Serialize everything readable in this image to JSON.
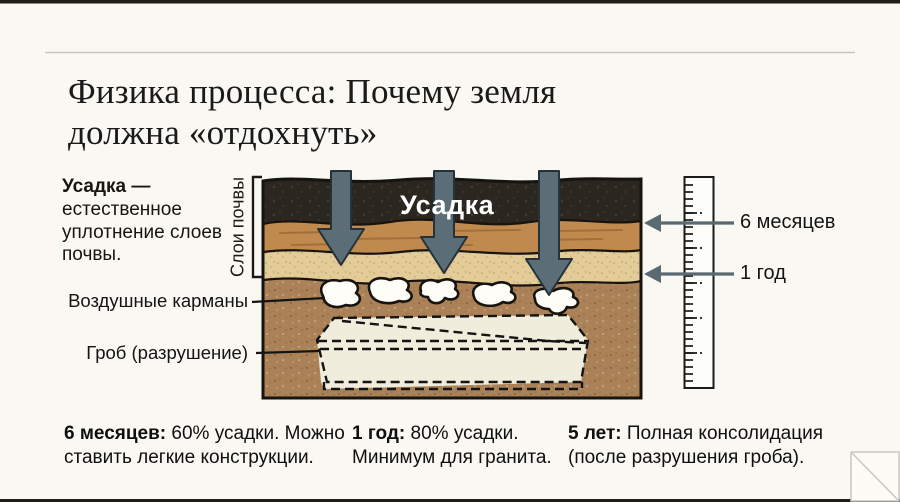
{
  "slide": {
    "title_line1": "Физика процесса: Почему земля",
    "title_line2": "должна «отдохнуть»"
  },
  "definition": {
    "term": "Усадка —",
    "text": "естественное уплотнение слоев почвы."
  },
  "diagram": {
    "side_label": "Слои почвы",
    "center_label": "Усадка",
    "pockets_label": "Воздушные карманы",
    "coffin_label": "Гроб (разрушение)",
    "ruler_marks": [
      {
        "label": "6 месяцев"
      },
      {
        "label": "1 год"
      }
    ]
  },
  "timeline": [
    {
      "term": "6 месяцев:",
      "text": " 60% усадки. Можно ставить легкие конструкции."
    },
    {
      "term": "1 год:",
      "text": " 80% усадки. Минимум для гранита."
    },
    {
      "term": "5 лет:",
      "text": " Полная консолидация (после разрушения гроба)."
    }
  ],
  "colors": {
    "bg": "#faf8f2",
    "bar": "#201d18",
    "rule": "#c9c6bd",
    "soil-dark": "#2c2620",
    "soil-orange": "#c08a4f",
    "soil-tan": "#e3cc98",
    "soil-brown": "#ab8158",
    "pocket": "#fffdf7",
    "coffin": "#f0eddc",
    "arrow": "#5b6e78",
    "arrow-edge": "#26323a",
    "pointer": "#5a6a71",
    "ruler-face": "#fdfdf9"
  }
}
